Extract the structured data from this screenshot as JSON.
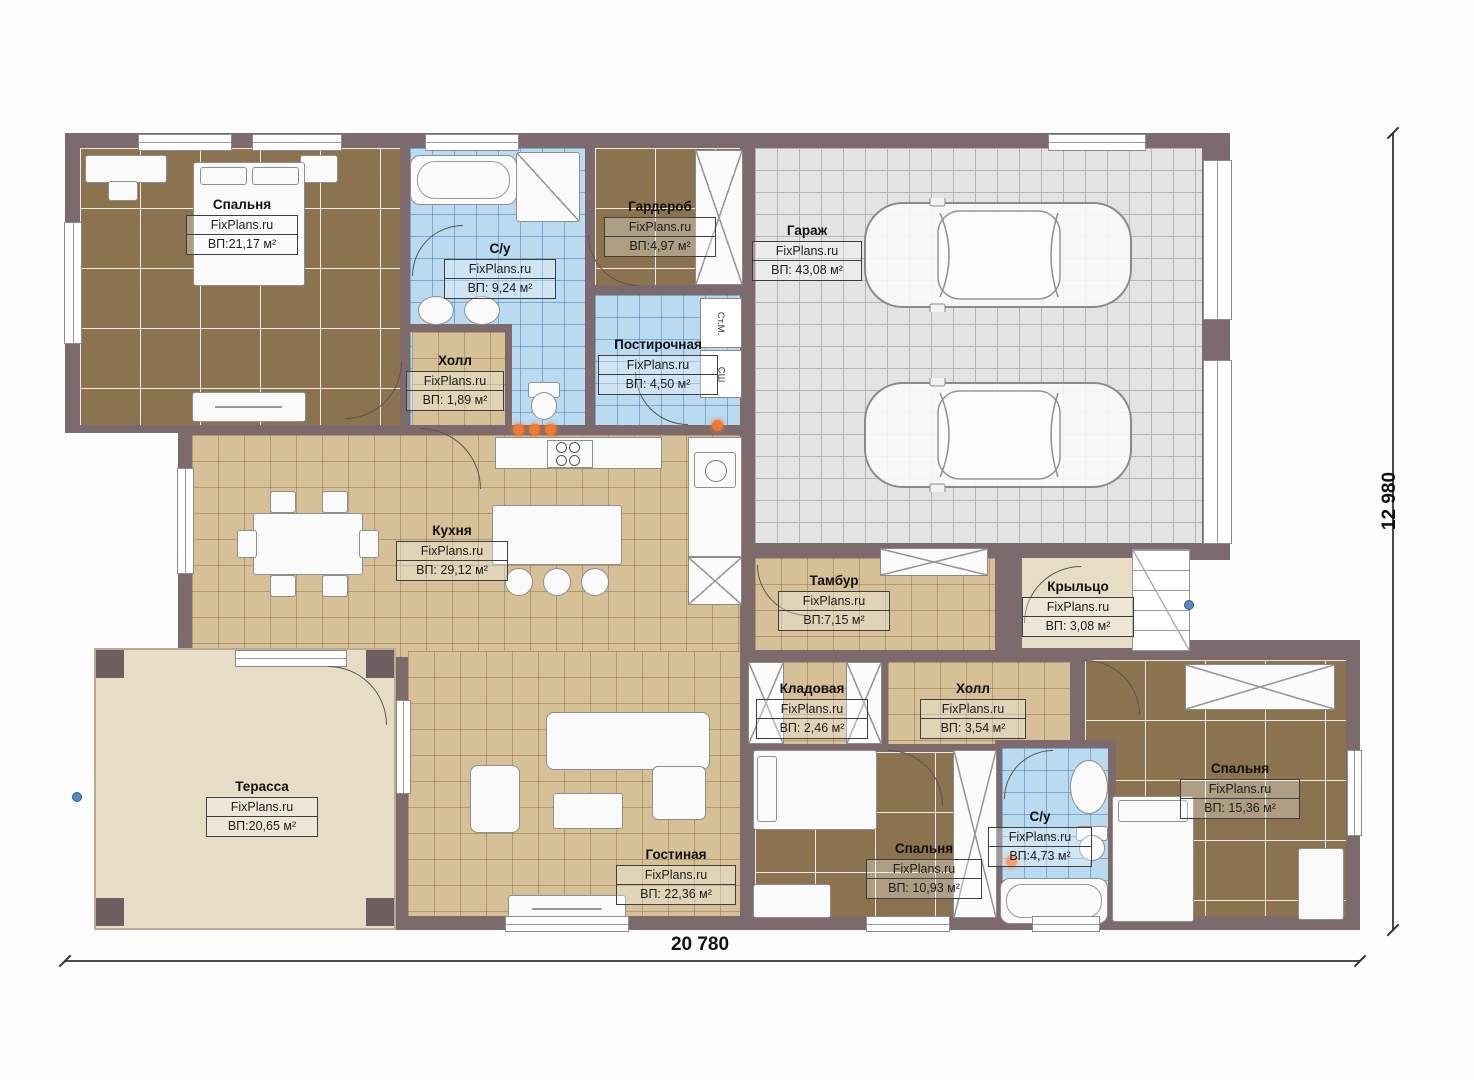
{
  "plan": {
    "watermark": "FixPlans.ru",
    "dimensions": {
      "width_label": "20 780",
      "height_label": "12 980"
    },
    "rooms": [
      {
        "name": "Спальня",
        "area": "ВП:21,17 м²"
      },
      {
        "name": "С/у",
        "area": "ВП: 9,24 м²"
      },
      {
        "name": "Гардероб",
        "area": "ВП:4,97 м²"
      },
      {
        "name": "Постирочная",
        "area": "ВП: 4,50 м²"
      },
      {
        "name": "Холл",
        "area": "ВП: 1,89 м²"
      },
      {
        "name": "Гараж",
        "area": "ВП: 43,08 м²"
      },
      {
        "name": "Кухня",
        "area": "ВП: 29,12 м²"
      },
      {
        "name": "Тамбур",
        "area": "ВП:7,15 м²"
      },
      {
        "name": "Крыльцо",
        "area": "ВП: 3,08 м²"
      },
      {
        "name": "Кладовая",
        "area": "ВП: 2,46 м²"
      },
      {
        "name": "Холл",
        "area": "ВП: 3,54 м²"
      },
      {
        "name": "Спальня",
        "area": "ВП: 15,36 м²"
      },
      {
        "name": "С/у",
        "area": "ВП:4,73 м²"
      },
      {
        "name": "Спальня",
        "area": "ВП: 10,93 м²"
      },
      {
        "name": "Гостиная",
        "area": "ВП: 22,36 м²"
      },
      {
        "name": "Терасса",
        "area": "ВП:20,65 м²"
      }
    ],
    "appliances": {
      "washing_machine": "Ст.М.",
      "dryer": "СШ"
    },
    "colors": {
      "wall": "#7c6a6c",
      "tile_tan": "#d5c097",
      "tile_brown": "#8a734e",
      "tile_blue": "#badaf0",
      "tile_gray": "#e3e3e3",
      "beige": "#e7dcc6",
      "accent_orange": "#f07830",
      "marker_blue": "#5b87c0"
    }
  }
}
